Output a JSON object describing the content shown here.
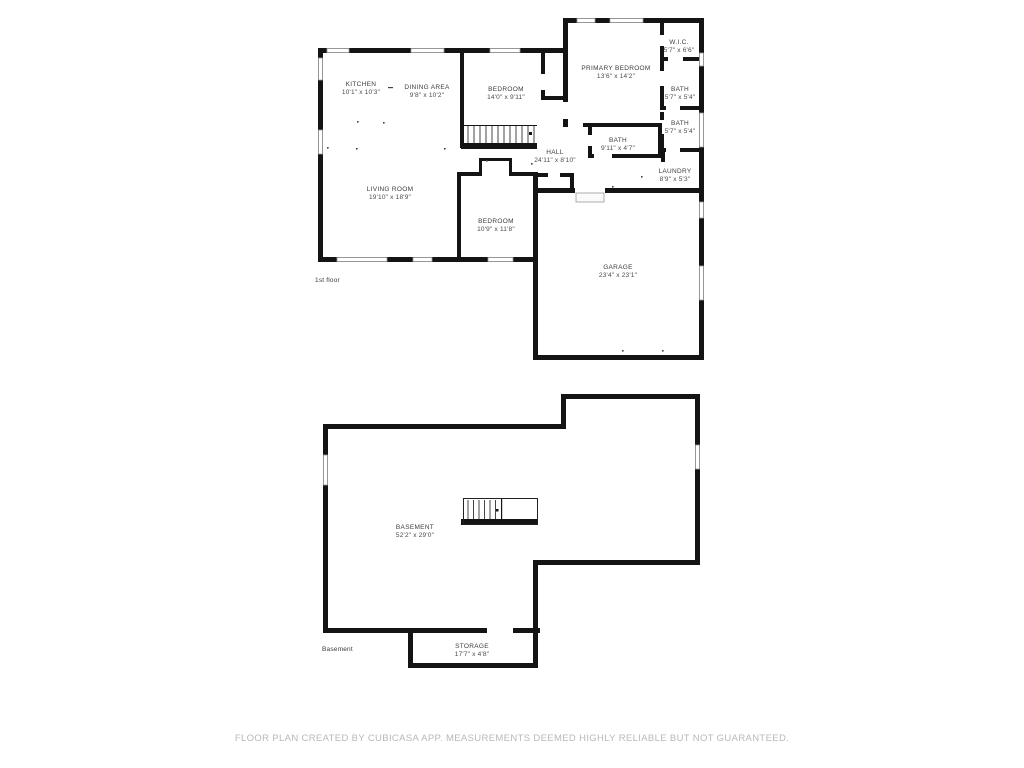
{
  "floors": {
    "first": {
      "label": "1st floor",
      "rooms": {
        "kitchen": {
          "name": "KITCHEN",
          "dims": "10'1\" x 10'3\""
        },
        "dining": {
          "name": "DINING AREA",
          "dims": "9'8\" x 10'2\""
        },
        "bedroom_top": {
          "name": "BEDROOM",
          "dims": "14'0\" x 9'11\""
        },
        "primary": {
          "name": "PRIMARY BEDROOM",
          "dims": "13'6\" x 14'2\""
        },
        "wic": {
          "name": "W.I.C.",
          "dims": "5'7\" x 6'6\""
        },
        "bath1": {
          "name": "BATH",
          "dims": "5'7\" x 5'4\""
        },
        "bath2": {
          "name": "BATH",
          "dims": "5'7\" x 5'4\""
        },
        "bath3": {
          "name": "BATH",
          "dims": "9'11\" x 4'7\""
        },
        "laundry": {
          "name": "LAUNDRY",
          "dims": "8'9\" x 5'3\""
        },
        "hall": {
          "name": "HALL",
          "dims": "24'11\" x 8'10\""
        },
        "living": {
          "name": "LIVING ROOM",
          "dims": "19'10\" x 18'9\""
        },
        "bedroom_bottom": {
          "name": "BEDROOM",
          "dims": "10'9\" x 11'8\""
        },
        "garage": {
          "name": "GARAGE",
          "dims": "23'4\" x 23'1\""
        }
      }
    },
    "basement": {
      "label": "Basement",
      "rooms": {
        "basement": {
          "name": "BASEMENT",
          "dims": "52'2\" x 29'0\""
        },
        "storage": {
          "name": "STORAGE",
          "dims": "17'7\" x 4'8\""
        }
      }
    }
  },
  "footer": {
    "text": "FLOOR PLAN CREATED BY CUBICASA APP. MEASUREMENTS DEEMED HIGHLY RELIABLE BUT NOT GUARANTEED."
  },
  "colors": {
    "wall": "#141414",
    "window_border": "#9a9a9a",
    "label": "#3d3d3d",
    "footer": "#b8b8b8"
  }
}
